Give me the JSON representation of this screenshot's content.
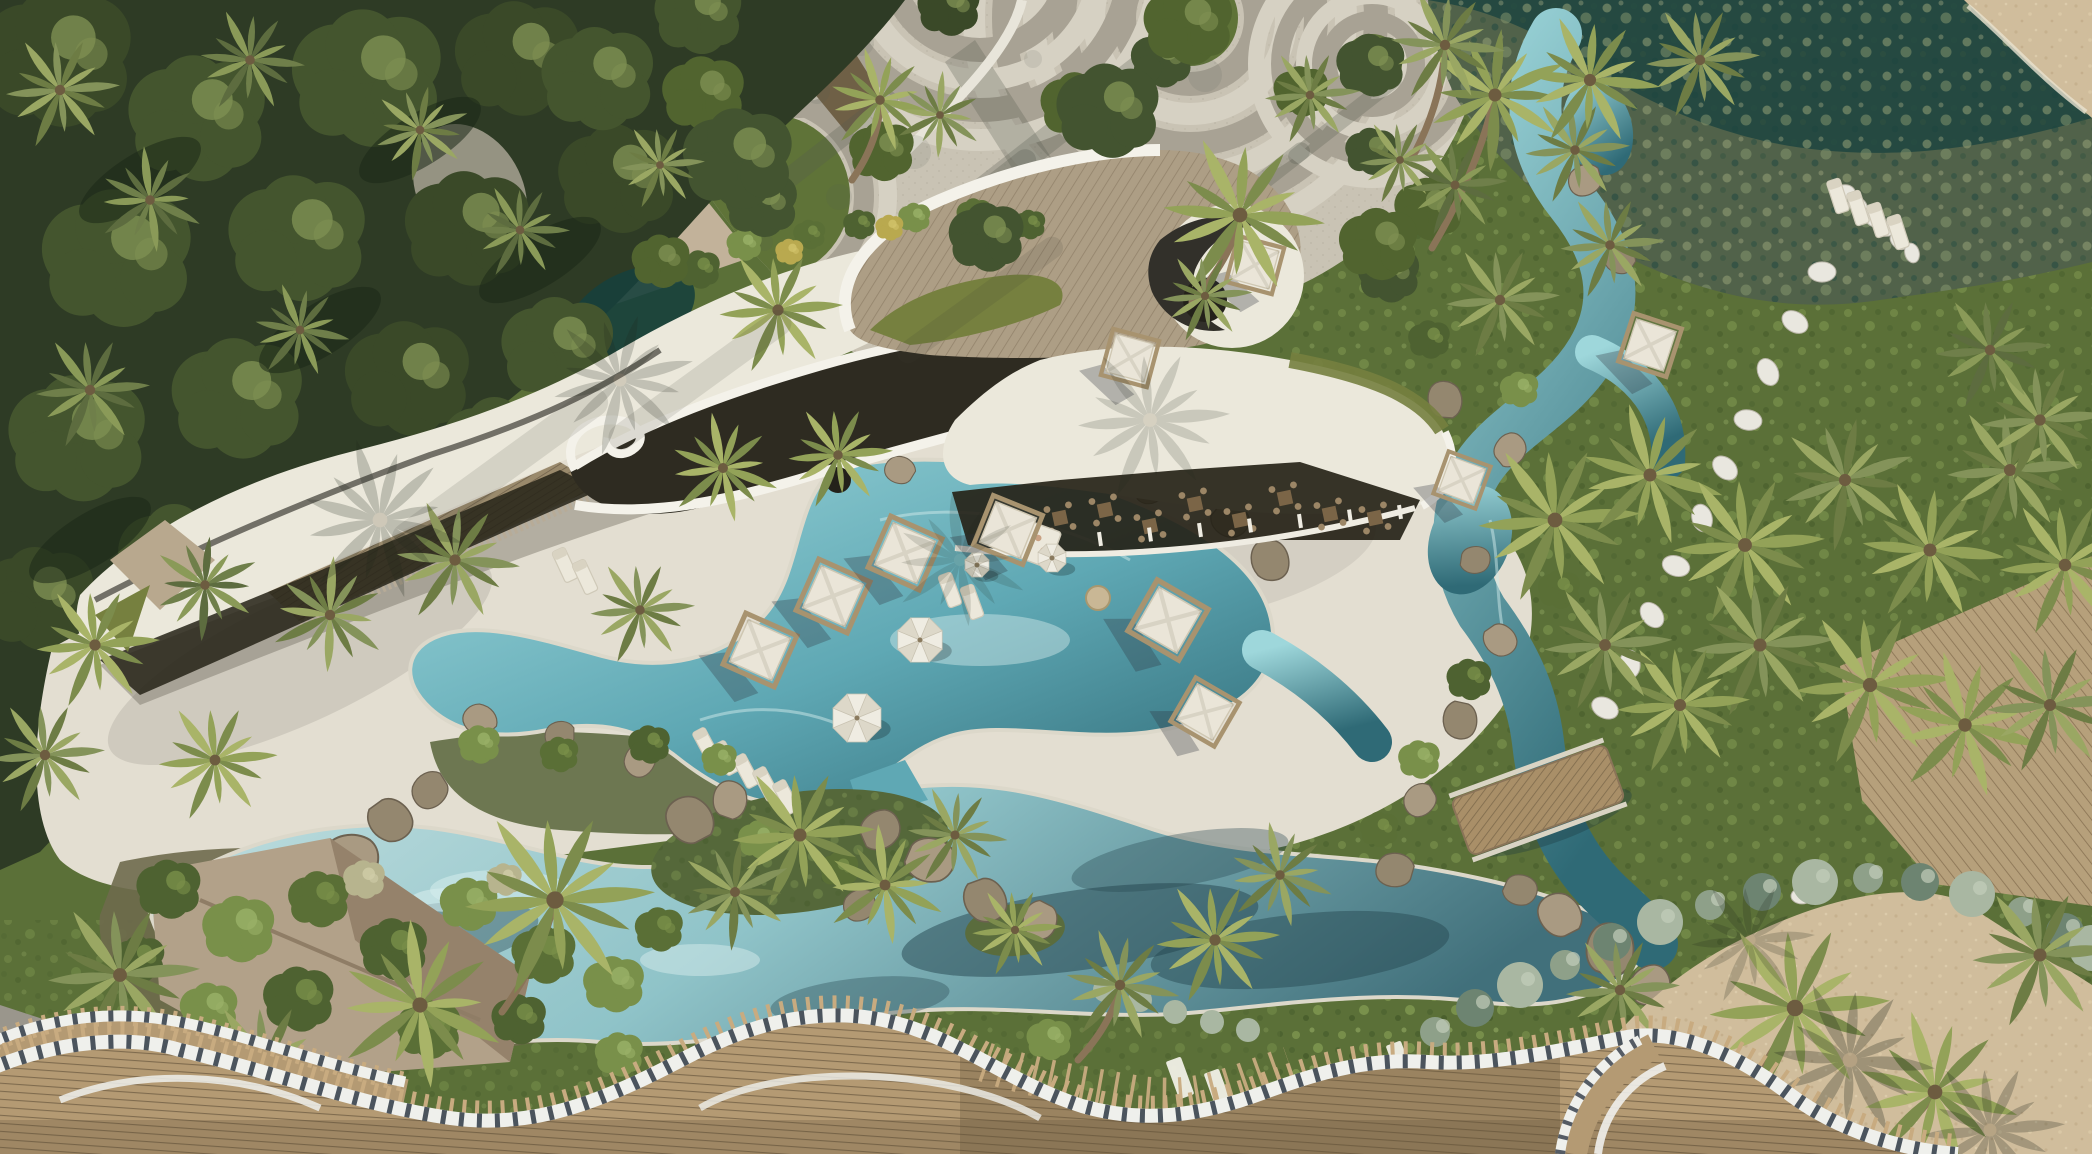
{
  "meta": {
    "title": "Aerial rendering of a tropical resort with organic-roofed clubhouse, lagoon pools, cabanas and palm groves",
    "description": "Top-down drone view: dense jungle at upper left, a circular paver plaza at top center, a shallow seagrass lagoon at top right, a sweeping white organic clubhouse roof with timber deck and palm oculi across the middle, a cream pool deck with white cabanas and umbrellas, a turquoise lazy-river pool winding through rock islands, green lawns with stepping-stone paths and palm groves on the right, a sandy beach at lower right, and a wavy woven-timber canopy with striped ribbon edge across the foreground.",
    "visible_text_present": false
  },
  "palette": {
    "jungle_base": "#2e3b25",
    "jungle_blob": "#44552e",
    "jungle_light": "#7e9052",
    "jungle_dark": "#1c2817",
    "lawn_base": "#5b7038",
    "lawn_light": "#87a055",
    "lawn_dark": "#3f5526",
    "plaza_base": "#c9c3b4",
    "plaza_ring_dark": "#a8a294",
    "plaza_ring_light": "#d6d1c3",
    "plaza_shadow": "#55594f",
    "seagrass_base": "#51624a",
    "seagrass_light": "#93a077",
    "seagrass_teal": "#1d453f",
    "sand": "#d0bd9c",
    "sand_light": "#dccaa9",
    "deck_cream": "#e3ded1",
    "deck_shadow": "#8a857a",
    "roof_white": "#ebe8db",
    "roof_bright": "#f4f2ea",
    "roof_wood": "#ad9e85",
    "roof_wood_line": "#93836b",
    "roof_dark": "#2e2b21",
    "roof_ridge": "#54514a",
    "louver": "#9a8a6c",
    "louver_line": "#6f604a",
    "roof_grass": "#76803f",
    "walkway_tan": "#c2b29a",
    "interior_dark": "#262318",
    "fascia_white": "#efece2",
    "stone_band": "#b7ab97",
    "pool_light": "#9ed7db",
    "pool_mid": "#5fa8b4",
    "pool_deep": "#2f6a76",
    "lagoon_light": "#c2dfe0",
    "lagoon_mid": "#8fc3c8",
    "lagoon_deep": "#41707b",
    "water_shadow": "#24444d",
    "water_light": "#d5ecec",
    "coping": "#dcd8ca",
    "rock_a": "#94876f",
    "rock_b": "#a99a82",
    "rock_dark": "#6c6150",
    "palm_a1": "#93a258",
    "palm_a2": "#7c8c4c",
    "palm_a3": "#a9b468",
    "palm_b1": "#84935a",
    "palm_b2": "#6d7c44",
    "palm_b3": "#9aa763",
    "palm_c1": "#6f7f4a",
    "palm_c2": "#5d6c3f",
    "palm_c3": "#8a9a58",
    "palm_shadow": "#20271b",
    "trunk": "#8a7458",
    "bush_green": "#4e6231",
    "bush_light": "#79904a",
    "bush_pale": "#a9b7a2",
    "bush_grey": "#8ea089",
    "bush_olive": "#6d8471",
    "bush_yellow": "#b9a94f",
    "soil": "#6e6a4c",
    "canopy_wood": "#b49a73",
    "canopy_slat": "#7f6b4e",
    "canopy_tip": "#c8ab80",
    "canopy_ribbon": "#eff0ec",
    "canopy_tick": "#39424e",
    "cabana_canopy": "#eae5d8",
    "cabana_frame": "#a8936f",
    "umbrella_light": "#efece2",
    "umbrella_mid": "#ddd8c9",
    "bridge_wood": "#a98f68",
    "stone_path": "#e9e7df",
    "pavilion_roof": "#b2a189",
    "pavilion_roof_dark": "#8f7d66",
    "shingle_grey": "#9a968c",
    "table_wood": "#7b6547",
    "chair_wood": "#9c8666",
    "furniture_white": "#ece8db",
    "pond_teal": "#17403c"
  },
  "scene": {
    "setting": "aerial drone view of a tropical beach resort (architectural rendering)",
    "regions": [
      {
        "name": "jungle-canopy",
        "desc": "dense tropical tree canopy, upper left"
      },
      {
        "name": "paver-plaza",
        "desc": "circular-patterned paved plaza with ringed tree islands, top center"
      },
      {
        "name": "seagrass-lagoon",
        "desc": "shallow green-water lagoon with seagrass mottling, top right"
      },
      {
        "name": "clubhouse-roof",
        "desc": "organic curved white concrete roof with rooftop timber deck, dark ramp, grass bands and palm oculi"
      },
      {
        "name": "restaurant-colonnade",
        "desc": "shaded dining terrace with timber tables beneath the roof edge"
      },
      {
        "name": "pool-deck",
        "desc": "cream stone deck with cabanas, umbrellas and sun loungers"
      },
      {
        "name": "lazy-river-pool",
        "desc": "turquoise free-form pool winding through rocks and planted islands"
      },
      {
        "name": "lagoon-pool",
        "desc": "wide reflective pool along the bottom with rock islands"
      },
      {
        "name": "right-gardens",
        "desc": "lawns with stepping-stone paths, hedges and dense palm groves"
      },
      {
        "name": "beach-sand",
        "desc": "sandy beach, lower right"
      },
      {
        "name": "timber-bridge",
        "desc": "slatted wooden bridge over the water channel"
      },
      {
        "name": "rattan-canopy",
        "desc": "wavy woven-timber canopy with white striped ribbon edge, foreground"
      }
    ],
    "objects": {
      "cabanas": 10,
      "umbrellas": 4,
      "sun_loungers": 13,
      "sun_mats": 6,
      "restaurant_tables": 8,
      "bridges": 1,
      "palm_trees": 60,
      "daybeds": 1,
      "poufs": 1
    }
  }
}
